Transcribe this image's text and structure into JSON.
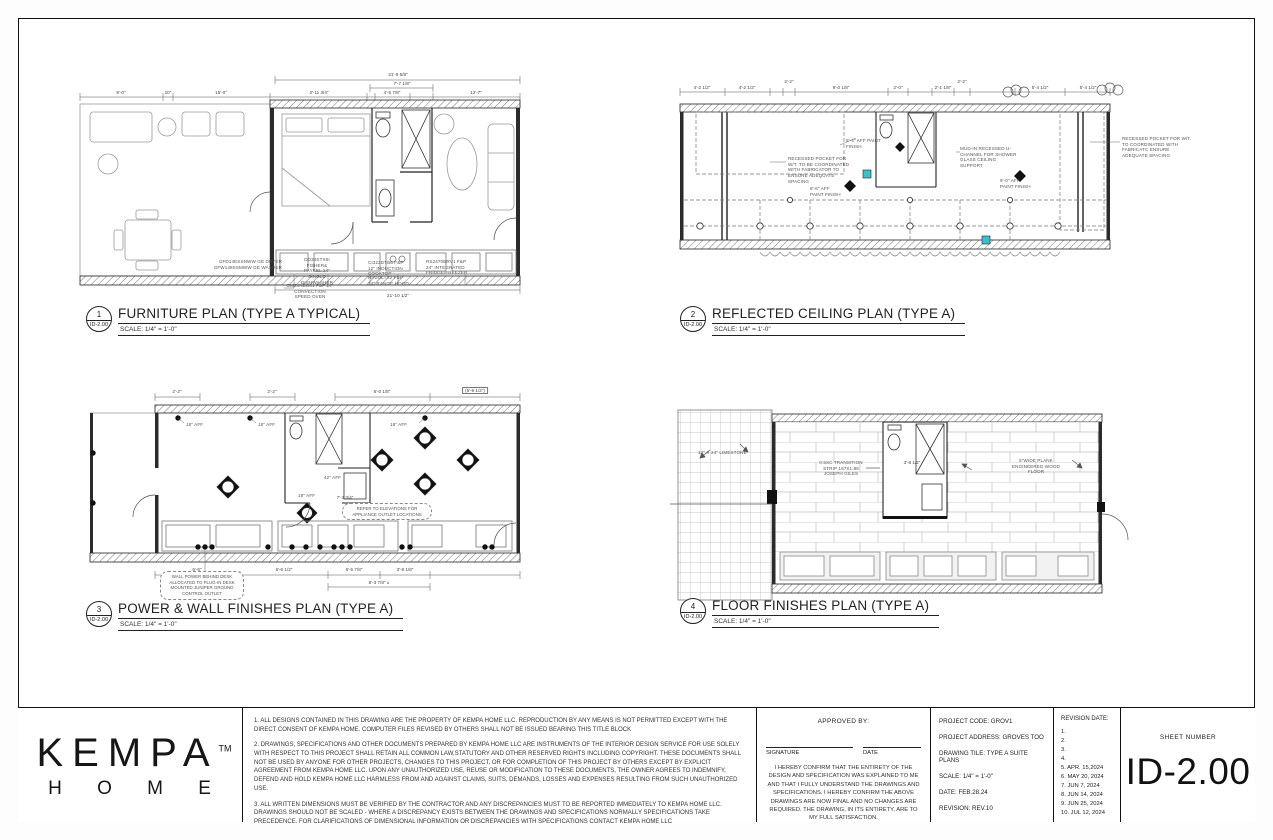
{
  "accent_teal": "#35c4cb",
  "titleblock": {
    "logo": {
      "brand": "KEMPA",
      "tm": "TM",
      "sub": "H O M E"
    },
    "notes": [
      "1. ALL DESIGNS CONTAINED IN THIS DRAWING ARE THE PROPERTY OF KEMPA HOME LLC. REPRODUCTION BY ANY MEANS IS NOT PERMITTED EXCEPT WITH THE DIRECT CONSENT OF KEMPA HOME. COMPUTER FILES REVISED BY OTHERS SHALL NOT BE ISSUED BEARING THIS TITLE BLOCK",
      "2. DRAWINGS, SPECIFICATIONS AND OTHER DOCUMENTS PREPARED BY KEMPA HOME LLC ARE INSTRUMENTS OF THE INTERIOR DESIGN SERVICE FOR USE SOLELY WITH RESPECT TO THIS PROJECT SHALL RETAIN ALL COMMON LAW,STATUTORY AND OTHER RESERVED RIGHTS INCLUDING COPYRIGHT. THESE DOCUMENTS SHALL NOT BE USED BY ANYONE FOR OTHER PROJECTS, CHANGES TO THIS PROJECT, OR FOR COMPLETION OF THIS PROJECT BY OTHERS EXCEPT BY EXPLICIT AGREEMENT FROM KEMPA HOME LLC. UPON ANY UNAUTHORIZED USE, REUSE OR MODIFICATION TO THESE DOCUMENTS, THE OWNER AGREES TO INDEMNIFY, DEFEND AND HOLD KEMPA HOME LLC HARMLESS FROM AND AGAINST CLAIMS, SUITS, DEMANDS, LOSSES AND EXPENSES RESULTING FROM SUCH UNAUTHORIZED USE.",
      "3. ALL WRITTEN DIMENSIONS MUST BE VERIFIED BY THE CONTRACTOR AND ANY DISCREPANCIES MUST TO BE REPORTED IMMEDIATELY TO KEMPA HOME LLC. DRAWINGS SHOULD NOT BE SCALED - WHERE A DISCREPANCY EXISTS BETWEEN THE DRAWINGS AND SPECIFICATIONS NORMALLY SPECIFICATIONS TAKE PRECEDENCE. FOR CLARIFICATIONS OF DIMENSIONAL INFORMATION OR DISCREPANCIES WITH SPECIFICATIONS CONTACT KEMPA HOME LLC"
    ],
    "approval": {
      "heading": "APPROVED BY:",
      "signature_label": "SIGNATURE",
      "date_label": "DATE",
      "statement": "I HEREBY CONFIRM THAT THE ENTIRETY OF THE DESIGN AND SPECIFICATION WAS EXPLAINED TO ME AND THAT I FULLY UNDERSTAND THE DRAWINGS AND SPECIFICATIONS. I HEREBY CONFIRM THE ABOVE DRAWINGS ARE NOW FINAL AND NO CHANGES ARE REQUIRED. THE DRAWING, IN ITS ENTIRETY, ARE TO MY FULL SATISFACTION."
    },
    "project": {
      "code": "PROJECT CODE: GROV1",
      "address": "PROJECT ADDRESS: GROVES TOO",
      "drawing_title": "DRAWING TILE: TYPE A SUITE PLANS",
      "scale": "SCALE: 1/4\" = 1'-0\"",
      "date": "DATE: FEB.28.24",
      "revision": "REVISION: REV.10"
    },
    "revisions": {
      "heading": "REVISION DATE:",
      "items": [
        "1.",
        "2.",
        "3.",
        "4.",
        "5. APR. 15,2024",
        "6. MAY 20, 2024",
        "7. JUN 7, 2024",
        "8. JUN 14, 2024",
        "9. JUN 25, 2024",
        "10. JUL 12, 2024"
      ]
    },
    "sheet_number": {
      "label": "SHEET NUMBER",
      "value": "ID-2.00"
    }
  },
  "plans": {
    "furniture": {
      "number": "1",
      "sheet_ref": "ID-2.00",
      "title": "FURNITURE PLAN (TYPE A TYPICAL)",
      "scale": "SCALE: 1/4\" = 1'-0\"",
      "dims": {
        "overall_top": "21'-9 5/8\"",
        "mid_top": "7'-7 1/8\"",
        "d1": "9'-0\"",
        "d2": "10\"",
        "d3": "15'-0\"",
        "d4": "2'-11 3/4\"",
        "d5": "4'-5 7/8\"",
        "d6": "12'-7\"",
        "bottom": "21'-10 1/2\""
      },
      "annotations": {
        "washer1": "GFD14ESSNWW GE DRYER",
        "washer2": "GFW148SSMWW GE WASHER",
        "dishwasher": "DD24STX6I FISHER& PAYKEL 24\" SINGLE DISHWASHER",
        "oven": "OM24NDB81 F&P 24\" CONVECTION SPEED OVEN",
        "cooktop": "CI322DTB6 F&P 12\" INDUCTION COOKTOP",
        "hood": "HP24ILTX2 F&P 24\" RANGE HOOD",
        "fridge": "RS2470BRV1 F&P 24\" INTEGRATED FRIDGE/FREEZER"
      }
    },
    "rcp": {
      "number": "2",
      "sheet_ref": "ID-2.00",
      "title": "REFLECTED CEILING PLAN (TYPE A)",
      "scale": "SCALE: 1/4\" = 1'-0\"",
      "dims": {
        "d1": "4'-2 1/2\"",
        "d2": "4'-2 1/2\"",
        "d3": "2'-2\"",
        "d4": "9'-0 1/8\"",
        "d5": "2'-0\"",
        "d6": "2'-1 1/8\"",
        "d7": "2'-2\"",
        "d8": "5'-4 1/2\"",
        "d9": "5'-4 1/2\""
      },
      "annotations": {
        "aff84": "8'-4\" AFF PAINT FINISH",
        "aff86": "8'-6\" AFF PAINT FINISH",
        "aff90": "9'-0\" AFF PAINT FINISH",
        "pocket_left": "RECESSED POCKET FOR W/T. TO BE COORDINATED WITH FABRICATOR TO ENSURE ADEQUATE SPACING",
        "mudin": "MUD-IN RECESSED U-CHANNEL FOR SHOWER GLASS CEILING SUPPORT",
        "pocket_right": "RECESSED POCKET FOR W/T. TO COORDINATED WITH FABRICATC ENSURE ADEQUATE SPACING"
      }
    },
    "power": {
      "number": "3",
      "sheet_ref": "ID-2.00",
      "title": "POWER & WALL FINISHES PLAN (TYPE A)",
      "scale": "SCALE: 1/4\" = 1'-0\"",
      "dims": {
        "t0": "6'-0 1/8\"",
        "t1": "2'-2\"",
        "t2": "2'-2\"",
        "t3": "6'-9 1/2\"",
        "t4": "(5'-9 1/2\")",
        "b1": "6'-6\"",
        "b2": "6'-6 1/2\"",
        "b3": "6'-5 7/8\"",
        "b4": "3'-8 1/8\"",
        "b5": "8'-3 7/8\" ±",
        "mid": "7'-3 3/4\""
      },
      "annotations": {
        "aff18": "18\" AFF",
        "aff42": "42\" AFF",
        "cloud1": "REFER TO ELEVATIONS FOR APPLIANCE OUTLET LOCATIONS",
        "cloud2": "WALL POWER BEHIND DESK ALLOCATED TO PLUG-IN DESK MOUNTED JUNIPER GROUND CONTROL OUTLET"
      }
    },
    "floor": {
      "number": "4",
      "sheet_ref": "ID-2.00",
      "title": "FLOOR FINISHES PLAN (TYPE A)",
      "scale": "SCALE: 1/4\" = 1'-0\"",
      "annotations": {
        "limestone": "12\" X 24\" LIMESTONE",
        "transition": "0.5SC TRANSITION STRIP 167X1.88 JOSEPH GILES",
        "dim": "3'-8 1/2\"",
        "wood": "5\"WIDE PLANK ENGINEERED WOOD FLOOR"
      }
    }
  }
}
